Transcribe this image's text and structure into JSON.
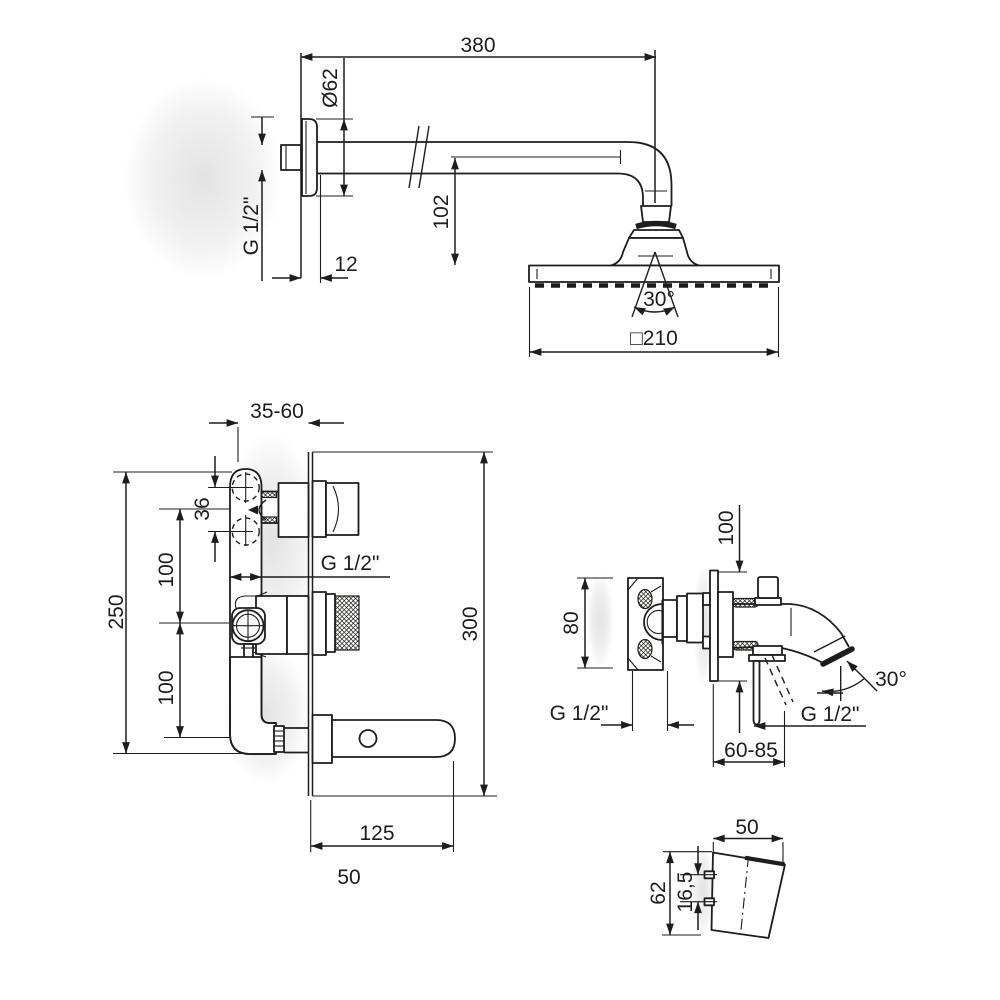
{
  "drawing": {
    "ink": "#1d1d1b",
    "background": "#ffffff",
    "type": "technical-dimension-drawing",
    "subject": "concealed shower and bath mixer set",
    "views": {
      "top": {
        "name": "shower-arm-and-head",
        "arm_length": "380",
        "flange_diameter": "Ø62",
        "wall_thread": "G 1/2\"",
        "flange_depth": "12",
        "head_drop": "102",
        "head_angle": "30°",
        "head_width": "□210"
      },
      "mixer": {
        "name": "concealed-mixer-front",
        "install_depth": "35-60",
        "port_spacing": "36",
        "span_upper": "100",
        "span_lower": "100",
        "overall_height": "250",
        "plate_height": "300",
        "outlet_thread": "G 1/2\"",
        "spout_projection": "125",
        "spout_width": "50"
      },
      "spout": {
        "name": "bath-spout-side",
        "plate_height": "100",
        "body_height": "80",
        "thread_left": "G 1/2\"",
        "thread_right": "G 1/2\"",
        "stream_angle": "30°",
        "reach_range": "60-85"
      },
      "handle": {
        "name": "handle-detail",
        "width": "50",
        "height": "62",
        "pin_spacing": "16,5"
      }
    }
  }
}
